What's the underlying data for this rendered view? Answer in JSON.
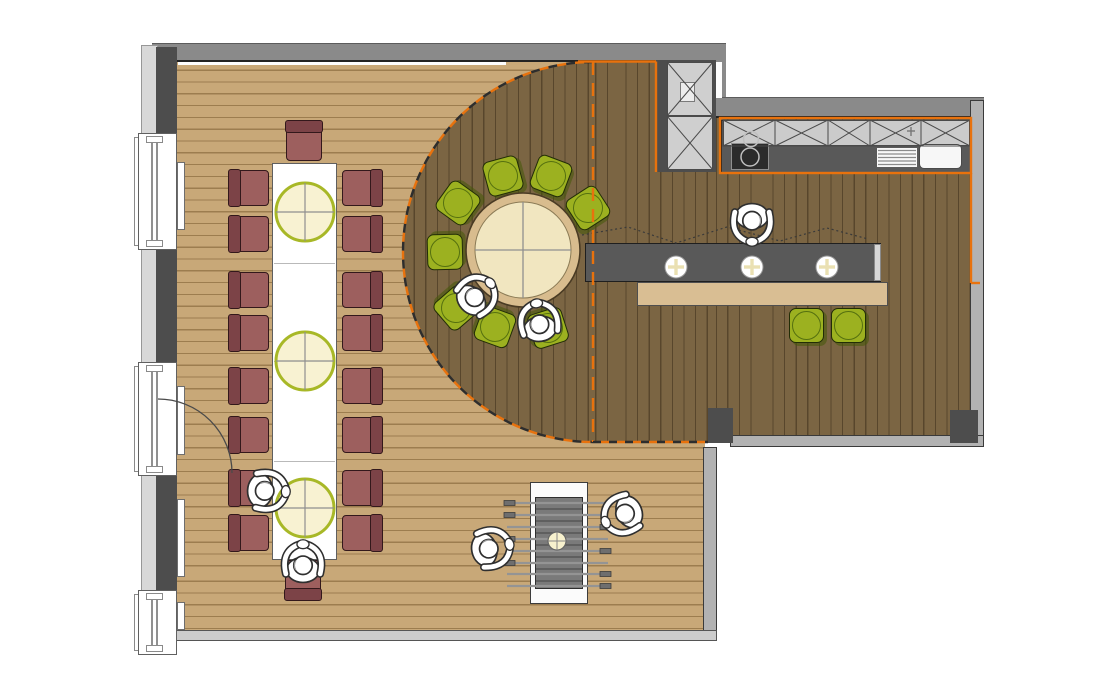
{
  "document": {
    "kind": "restaurant floor plan",
    "canvas_w": 1110,
    "canvas_h": 675
  },
  "palette": {
    "wall_gray": "#8a8a8a",
    "wall_dark": "#4d4d4d",
    "wall_light": "#b2b2b2",
    "floor_light": "#C8A878",
    "floor_dark": "#7B6543",
    "accent_orange": "#E8720D",
    "chair_maroon": "#9D5F5E",
    "chair_maroon_back": "#7C4347",
    "seat_green": "#9CB120",
    "counter_dark": "#595959",
    "wood_tan": "#D9BE93",
    "lamp_fill": "#F7F1CD",
    "lamp_stroke": "#A8B827",
    "cream": "#F1E6C0",
    "table_rim": "#D8BC8E"
  },
  "zones": [
    {
      "name": "dining-area-light-wood-floor"
    },
    {
      "name": "raised-platform-dark-wood-floor"
    },
    {
      "name": "kitchen-run"
    },
    {
      "name": "bar-counter-zone"
    }
  ],
  "floors": {
    "light": {
      "x": 177,
      "y": 62,
      "w": 528,
      "h": 570
    },
    "dark_circle": {
      "x": 403,
      "y": 62,
      "w": 380,
      "h": 380
    },
    "dark_rect1": {
      "x": 593,
      "y": 62,
      "w": 123,
      "h": 380
    },
    "dark_rect2": {
      "x": 716,
      "y": 118,
      "w": 254,
      "h": 324
    }
  },
  "walls": [
    {
      "name": "top-wall",
      "cls": "wall-gray",
      "x": 152,
      "y": 43,
      "w": 574,
      "h": 19
    },
    {
      "name": "top-wall-corner",
      "cls": "wall-gray",
      "x": 714,
      "y": 43,
      "w": 12,
      "h": 60
    },
    {
      "name": "kitchen-top-wall",
      "cls": "wall-gray",
      "x": 714,
      "y": 97,
      "w": 270,
      "h": 21
    },
    {
      "name": "right-wall",
      "cls": "wall-light",
      "x": 970,
      "y": 100,
      "w": 14,
      "h": 347
    },
    {
      "name": "bottom-right-wall",
      "cls": "wall-light",
      "x": 730,
      "y": 435,
      "w": 254,
      "h": 12
    },
    {
      "name": "wall-stub",
      "cls": "wall-dark",
      "x": 708,
      "y": 408,
      "w": 25,
      "h": 35
    },
    {
      "name": "wall-corner-block",
      "cls": "wall-dark",
      "x": 950,
      "y": 410,
      "w": 28,
      "h": 33
    },
    {
      "name": "lower-right-wall",
      "cls": "wall-light",
      "x": 703,
      "y": 447,
      "w": 14,
      "h": 187
    },
    {
      "name": "bottom-wall",
      "cls": "wall-lighter",
      "x": 168,
      "y": 630,
      "w": 549,
      "h": 11
    },
    {
      "name": "left-facade",
      "cls": "facade",
      "x": 141,
      "y": 45,
      "w": 17,
      "h": 610
    },
    {
      "name": "gap-outside",
      "cls": "white-line",
      "x": 716,
      "y": 62,
      "w": 6,
      "h": 36
    },
    {
      "name": "top-wall-inner-line",
      "cls": "white-line",
      "x": 178,
      "y": 62,
      "w": 328,
      "h": 3
    }
  ],
  "left_wall_segments": [
    {
      "y": 47,
      "h": 86
    },
    {
      "y": 250,
      "h": 112
    },
    {
      "y": 476,
      "h": 114
    }
  ],
  "windows": [
    {
      "y": 133,
      "h": 117
    },
    {
      "y": 362,
      "h": 114
    },
    {
      "y": 590,
      "h": 65
    }
  ],
  "radiators": [
    {
      "y": 162,
      "h": 68
    },
    {
      "y": 386,
      "h": 69
    },
    {
      "y": 499,
      "h": 78
    },
    {
      "y": 602,
      "h": 28
    }
  ],
  "long_table": {
    "x": 272,
    "y": 163,
    "w": 65,
    "h": 397,
    "seams": [
      100,
      198,
      298
    ],
    "lamps": [
      [
        305,
        212
      ],
      [
        305,
        361
      ],
      [
        305,
        508
      ]
    ],
    "lamp_r": 29
  },
  "maroon_chairs": [
    {
      "x": 249,
      "y": 188,
      "rot": 90
    },
    {
      "x": 249,
      "y": 234,
      "rot": 90
    },
    {
      "x": 249,
      "y": 290,
      "rot": 90
    },
    {
      "x": 249,
      "y": 333,
      "rot": 90
    },
    {
      "x": 249,
      "y": 386,
      "rot": 90
    },
    {
      "x": 249,
      "y": 435,
      "rot": 90
    },
    {
      "x": 249,
      "y": 488,
      "rot": 90
    },
    {
      "x": 249,
      "y": 533,
      "rot": 90
    },
    {
      "x": 362,
      "y": 188,
      "rot": 270
    },
    {
      "x": 362,
      "y": 234,
      "rot": 270
    },
    {
      "x": 362,
      "y": 290,
      "rot": 270
    },
    {
      "x": 362,
      "y": 333,
      "rot": 270
    },
    {
      "x": 362,
      "y": 386,
      "rot": 270
    },
    {
      "x": 362,
      "y": 435,
      "rot": 270
    },
    {
      "x": 362,
      "y": 488,
      "rot": 270
    },
    {
      "x": 362,
      "y": 533,
      "rot": 270
    },
    {
      "x": 304,
      "y": 141,
      "rot": 180
    },
    {
      "x": 303,
      "y": 580,
      "rot": 0
    }
  ],
  "round_table": {
    "cx": 523,
    "cy": 250,
    "r_outer": 57,
    "r_inner": 48
  },
  "green_seats": [
    {
      "x": 503,
      "y": 176,
      "size": 36,
      "face_center": true
    },
    {
      "x": 551,
      "y": 176,
      "size": 36,
      "face_center": true
    },
    {
      "x": 458,
      "y": 203,
      "size": 36,
      "face_center": true
    },
    {
      "x": 588,
      "y": 208,
      "size": 36,
      "face_center": true
    },
    {
      "x": 445,
      "y": 252,
      "size": 36,
      "face_center": true
    },
    {
      "x": 456,
      "y": 308,
      "size": 36,
      "face_center": true
    },
    {
      "x": 495,
      "y": 327,
      "size": 36,
      "face_center": true
    },
    {
      "x": 548,
      "y": 328,
      "size": 36,
      "face_center": true
    },
    {
      "x": 806,
      "y": 325,
      "size": 35,
      "rot": 0,
      "stool": true
    },
    {
      "x": 848,
      "y": 325,
      "size": 35,
      "rot": 0,
      "stool": true
    }
  ],
  "bar": {
    "counter": {
      "x": 585,
      "y": 243,
      "w": 296,
      "h": 39
    },
    "cap": {
      "x": 874,
      "y": 244,
      "w": 7,
      "h": 37
    },
    "ledge": {
      "x": 637,
      "y": 282,
      "w": 251,
      "h": 24
    },
    "plates": [
      [
        676,
        267
      ],
      [
        752,
        267
      ],
      [
        827,
        267
      ]
    ],
    "plate_r": 11,
    "zigzag": "582,235 628,227 676,243 727,227 780,241 827,228 868,239"
  },
  "kitchen": {
    "counter": {
      "x": 721,
      "y": 120,
      "w": 250,
      "h": 53
    },
    "cab_row": {
      "x": 723,
      "y": 120,
      "w": 247,
      "h": 26
    },
    "x_boxes": [
      [
        723,
        775
      ],
      [
        775,
        828
      ],
      [
        828,
        870
      ],
      [
        870,
        921
      ],
      [
        921,
        970
      ]
    ],
    "x_box_y": [
      120,
      146
    ],
    "stove": {
      "x": 731,
      "y": 143,
      "w": 38,
      "h": 27
    },
    "burners": [
      [
        750,
        157,
        9
      ],
      [
        751,
        139,
        7.5
      ]
    ],
    "drain": {
      "x": 876,
      "y": 147,
      "w": 42,
      "h": 21
    },
    "drain_line_ys": [
      150.5,
      154,
      157.5,
      161,
      164.5
    ],
    "sink": {
      "x": 919,
      "y": 144,
      "w": 43,
      "h": 25
    },
    "faucet": [
      911,
      131
    ],
    "tall_cabinet": {
      "x": 655,
      "y": 60,
      "w": 61,
      "h": 112
    },
    "tall_panels": [
      [
        667,
        62,
        46,
        54
      ],
      [
        667,
        116,
        46,
        54
      ]
    ],
    "note_rect": {
      "x": 680,
      "y": 82,
      "w": 15,
      "h": 20
    }
  },
  "foosball": {
    "body": {
      "x": 530,
      "y": 482,
      "w": 58,
      "h": 122
    },
    "field": {
      "x": 535,
      "y": 497,
      "w": 48,
      "h": 92
    },
    "ball": [
      557,
      541
    ],
    "ball_r": 9,
    "rod_ys": [
      503,
      515,
      527,
      539,
      551,
      563,
      574,
      586
    ],
    "rod_x1": 507,
    "rod_x2": 608,
    "left_handles": [
      0,
      1,
      3,
      5
    ],
    "right_handles": [
      2,
      4,
      6,
      7
    ]
  },
  "door": {
    "arc": "M158,399 A74,74 0 0 1 232,473"
  },
  "boundary": {
    "arc": "M593,62 A190,190 0 0 0 403,252 A190,190 0 0 0 593,442",
    "vline": "M593,62 L593,442",
    "hline": "M593,442 L708,442",
    "solid": [
      "M578,61.5 L656,61.5",
      "M656,61.5 L656,172",
      "M971,173 L971,283",
      "M971,283 L980,283"
    ],
    "kitchen_outline": {
      "x": 720,
      "y": 118,
      "w": 251,
      "h": 55
    }
  },
  "people": [
    {
      "x": 268,
      "y": 491,
      "rot": 92,
      "role": "diner-long-table-side"
    },
    {
      "x": 303,
      "y": 562,
      "rot": 0,
      "role": "diner-long-table-end"
    },
    {
      "x": 477,
      "y": 295,
      "rot": 48,
      "role": "diner-round-table-southwest"
    },
    {
      "x": 539,
      "y": 321,
      "rot": -8,
      "role": "diner-round-table-south"
    },
    {
      "x": 752,
      "y": 224,
      "rot": 180,
      "role": "guest-standing-at-bar"
    },
    {
      "x": 492,
      "y": 548,
      "rot": 78,
      "role": "foosball-player-left"
    },
    {
      "x": 622,
      "y": 515,
      "rot": 246,
      "role": "foosball-player-right"
    }
  ]
}
